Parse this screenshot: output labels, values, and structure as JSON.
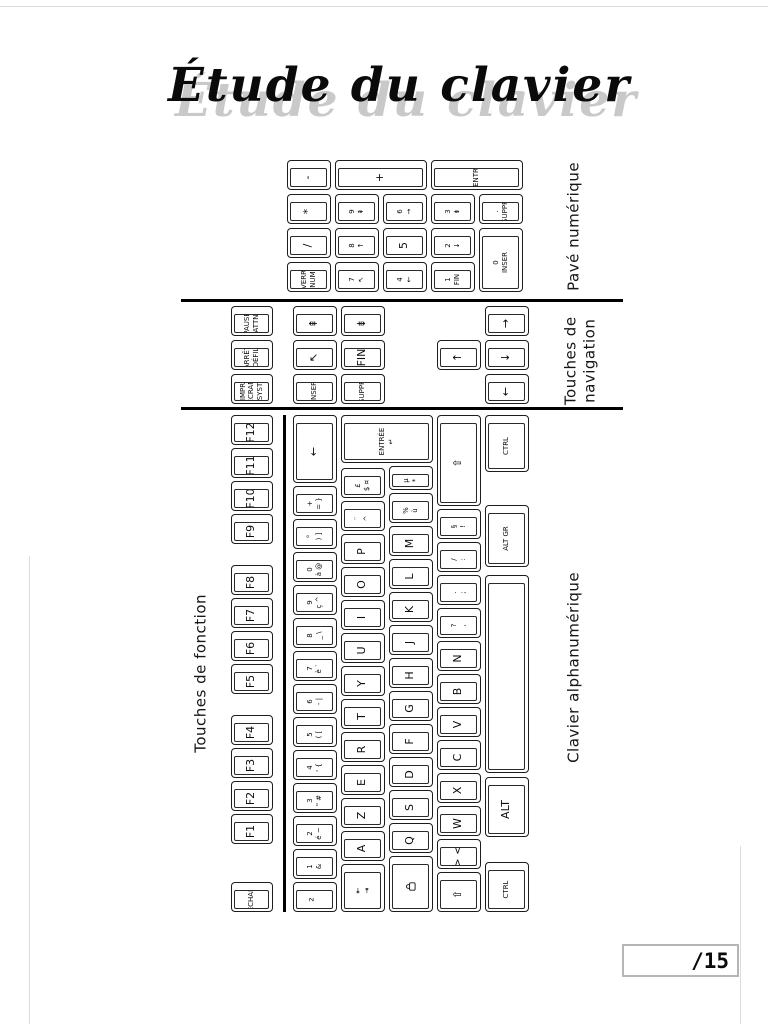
{
  "title": {
    "text": "Étude du clavier"
  },
  "score_box": {
    "value": "/15"
  },
  "section_labels": {
    "pave": "Pavé numérique",
    "nav_line1": "Touches de",
    "nav_line2": "navigation",
    "fonction": "Touches de fonction",
    "alpha": "Clavier alphanumérique"
  },
  "colors": {
    "ink": "#111111",
    "shadow": "#c9c9c9",
    "rule": "#000000",
    "score_border": "#b5b5b5"
  },
  "keyboard": {
    "orientation": "rotated-90-ccw",
    "keys": [
      {
        "n": "key-echap",
        "x": 0,
        "y": 6,
        "w": 30,
        "h": 42,
        "t": [
          "ÉCHAP"
        ]
      },
      {
        "n": "key-f1",
        "x": 68,
        "y": 6,
        "w": 30,
        "h": 42,
        "t": [
          "F1"
        ]
      },
      {
        "n": "key-f2",
        "x": 101,
        "y": 6,
        "w": 30,
        "h": 42,
        "t": [
          "F2"
        ]
      },
      {
        "n": "key-f3",
        "x": 134,
        "y": 6,
        "w": 30,
        "h": 42,
        "t": [
          "F3"
        ]
      },
      {
        "n": "key-f4",
        "x": 167,
        "y": 6,
        "w": 30,
        "h": 42,
        "t": [
          "F4"
        ]
      },
      {
        "n": "key-f5",
        "x": 218,
        "y": 6,
        "w": 30,
        "h": 42,
        "t": [
          "F5"
        ]
      },
      {
        "n": "key-f6",
        "x": 251,
        "y": 6,
        "w": 30,
        "h": 42,
        "t": [
          "F6"
        ]
      },
      {
        "n": "key-f7",
        "x": 284,
        "y": 6,
        "w": 30,
        "h": 42,
        "t": [
          "F7"
        ]
      },
      {
        "n": "key-f8",
        "x": 317,
        "y": 6,
        "w": 30,
        "h": 42,
        "t": [
          "F8"
        ]
      },
      {
        "n": "key-f9",
        "x": 368,
        "y": 6,
        "w": 30,
        "h": 42,
        "t": [
          "F9"
        ]
      },
      {
        "n": "key-f10",
        "x": 401,
        "y": 6,
        "w": 30,
        "h": 42,
        "t": [
          "F10"
        ]
      },
      {
        "n": "key-f11",
        "x": 434,
        "y": 6,
        "w": 30,
        "h": 42,
        "t": [
          "F11"
        ]
      },
      {
        "n": "key-f12",
        "x": 467,
        "y": 6,
        "w": 30,
        "h": 42,
        "t": [
          "F12"
        ]
      },
      {
        "n": "key-superscript2",
        "x": 0,
        "y": 68,
        "w": 30,
        "h": 44,
        "t": [
          "²"
        ]
      },
      {
        "n": "key-1",
        "x": 33,
        "y": 68,
        "w": 30,
        "h": 44,
        "t": [
          "1",
          "&"
        ]
      },
      {
        "n": "key-2",
        "x": 66,
        "y": 68,
        "w": 30,
        "h": 44,
        "t": [
          "2",
          "é ~"
        ]
      },
      {
        "n": "key-3",
        "x": 99,
        "y": 68,
        "w": 30,
        "h": 44,
        "t": [
          "3",
          "\" #"
        ]
      },
      {
        "n": "key-4",
        "x": 132,
        "y": 68,
        "w": 30,
        "h": 44,
        "t": [
          "4",
          "' {"
        ]
      },
      {
        "n": "key-5",
        "x": 165,
        "y": 68,
        "w": 30,
        "h": 44,
        "t": [
          "5",
          "( ["
        ]
      },
      {
        "n": "key-6",
        "x": 198,
        "y": 68,
        "w": 30,
        "h": 44,
        "t": [
          "6",
          "- |"
        ]
      },
      {
        "n": "key-7",
        "x": 231,
        "y": 68,
        "w": 30,
        "h": 44,
        "t": [
          "7",
          "è `"
        ]
      },
      {
        "n": "key-8",
        "x": 264,
        "y": 68,
        "w": 30,
        "h": 44,
        "t": [
          "8",
          "_ \\"
        ]
      },
      {
        "n": "key-9",
        "x": 297,
        "y": 68,
        "w": 30,
        "h": 44,
        "t": [
          "9",
          "ç ^"
        ]
      },
      {
        "n": "key-0",
        "x": 330,
        "y": 68,
        "w": 30,
        "h": 44,
        "t": [
          "0",
          "à @"
        ]
      },
      {
        "n": "key-degree",
        "x": 363,
        "y": 68,
        "w": 30,
        "h": 44,
        "t": [
          "°",
          ") ]"
        ]
      },
      {
        "n": "key-plus-equal",
        "x": 396,
        "y": 68,
        "w": 30,
        "h": 44,
        "t": [
          "+",
          "= }"
        ]
      },
      {
        "n": "key-backspace",
        "x": 429,
        "y": 68,
        "w": 68,
        "h": 44,
        "t": [
          "←"
        ]
      },
      {
        "n": "key-tab",
        "x": 0,
        "y": 116,
        "w": 48,
        "h": 44,
        "t": [
          "⇤",
          "⇥"
        ]
      },
      {
        "n": "key-a",
        "x": 51,
        "y": 116,
        "w": 30,
        "h": 44,
        "t": [
          "A"
        ]
      },
      {
        "n": "key-z",
        "x": 84,
        "y": 116,
        "w": 30,
        "h": 44,
        "t": [
          "Z"
        ]
      },
      {
        "n": "key-e",
        "x": 117,
        "y": 116,
        "w": 30,
        "h": 44,
        "t": [
          "E"
        ]
      },
      {
        "n": "key-r",
        "x": 150,
        "y": 116,
        "w": 30,
        "h": 44,
        "t": [
          "R"
        ]
      },
      {
        "n": "key-t",
        "x": 183,
        "y": 116,
        "w": 30,
        "h": 44,
        "t": [
          "T"
        ]
      },
      {
        "n": "key-y",
        "x": 216,
        "y": 116,
        "w": 30,
        "h": 44,
        "t": [
          "Y"
        ]
      },
      {
        "n": "key-u",
        "x": 249,
        "y": 116,
        "w": 30,
        "h": 44,
        "t": [
          "U"
        ]
      },
      {
        "n": "key-i",
        "x": 282,
        "y": 116,
        "w": 30,
        "h": 44,
        "t": [
          "I"
        ]
      },
      {
        "n": "key-o",
        "x": 315,
        "y": 116,
        "w": 30,
        "h": 44,
        "t": [
          "O"
        ]
      },
      {
        "n": "key-p",
        "x": 348,
        "y": 116,
        "w": 30,
        "h": 44,
        "t": [
          "P"
        ]
      },
      {
        "n": "key-circumflex",
        "x": 381,
        "y": 116,
        "w": 30,
        "h": 44,
        "t": [
          "¨",
          "^"
        ]
      },
      {
        "n": "key-dollar",
        "x": 414,
        "y": 116,
        "w": 30,
        "h": 44,
        "t": [
          "£",
          "$ ¤"
        ]
      },
      {
        "n": "key-entree",
        "x": 449,
        "y": 116,
        "w": 48,
        "h": 92,
        "t": [
          "ENTRÉE",
          "↵"
        ]
      },
      {
        "n": "key-verr-maj",
        "x": 0,
        "y": 164,
        "w": 56,
        "h": 44,
        "t": [],
        "icon": "padlock-icon"
      },
      {
        "n": "key-q",
        "x": 59,
        "y": 164,
        "w": 30,
        "h": 44,
        "t": [
          "Q"
        ]
      },
      {
        "n": "key-s",
        "x": 92,
        "y": 164,
        "w": 30,
        "h": 44,
        "t": [
          "S"
        ]
      },
      {
        "n": "key-d",
        "x": 125,
        "y": 164,
        "w": 30,
        "h": 44,
        "t": [
          "D"
        ]
      },
      {
        "n": "key-f",
        "x": 158,
        "y": 164,
        "w": 30,
        "h": 44,
        "t": [
          "F"
        ]
      },
      {
        "n": "key-g",
        "x": 191,
        "y": 164,
        "w": 30,
        "h": 44,
        "t": [
          "G"
        ]
      },
      {
        "n": "key-h",
        "x": 224,
        "y": 164,
        "w": 30,
        "h": 44,
        "t": [
          "H"
        ]
      },
      {
        "n": "key-j",
        "x": 257,
        "y": 164,
        "w": 30,
        "h": 44,
        "t": [
          "J"
        ]
      },
      {
        "n": "key-k",
        "x": 290,
        "y": 164,
        "w": 30,
        "h": 44,
        "t": [
          "K"
        ]
      },
      {
        "n": "key-l",
        "x": 323,
        "y": 164,
        "w": 30,
        "h": 44,
        "t": [
          "L"
        ]
      },
      {
        "n": "key-m",
        "x": 356,
        "y": 164,
        "w": 30,
        "h": 44,
        "t": [
          "M"
        ]
      },
      {
        "n": "key-percent",
        "x": 389,
        "y": 164,
        "w": 30,
        "h": 44,
        "t": [
          "%",
          "ù"
        ]
      },
      {
        "n": "key-asterisk",
        "x": 422,
        "y": 164,
        "w": 24,
        "h": 44,
        "t": [
          "µ",
          "*"
        ]
      },
      {
        "n": "key-shift-left",
        "x": 0,
        "y": 212,
        "w": 40,
        "h": 44,
        "t": [
          "⇧"
        ]
      },
      {
        "n": "key-less-greater",
        "x": 43,
        "y": 212,
        "w": 30,
        "h": 44,
        "t": [
          "> <"
        ]
      },
      {
        "n": "key-w",
        "x": 76,
        "y": 212,
        "w": 30,
        "h": 44,
        "t": [
          "W"
        ]
      },
      {
        "n": "key-x",
        "x": 109,
        "y": 212,
        "w": 30,
        "h": 44,
        "t": [
          "X"
        ]
      },
      {
        "n": "key-c",
        "x": 142,
        "y": 212,
        "w": 30,
        "h": 44,
        "t": [
          "C"
        ]
      },
      {
        "n": "key-v",
        "x": 175,
        "y": 212,
        "w": 30,
        "h": 44,
        "t": [
          "V"
        ]
      },
      {
        "n": "key-b",
        "x": 208,
        "y": 212,
        "w": 30,
        "h": 44,
        "t": [
          "B"
        ]
      },
      {
        "n": "key-n",
        "x": 241,
        "y": 212,
        "w": 30,
        "h": 44,
        "t": [
          "N"
        ]
      },
      {
        "n": "key-comma",
        "x": 274,
        "y": 212,
        "w": 30,
        "h": 44,
        "t": [
          "?",
          ","
        ]
      },
      {
        "n": "key-semicolon",
        "x": 307,
        "y": 212,
        "w": 30,
        "h": 44,
        "t": [
          ".",
          ";"
        ]
      },
      {
        "n": "key-colon",
        "x": 340,
        "y": 212,
        "w": 30,
        "h": 44,
        "t": [
          "/",
          ":"
        ]
      },
      {
        "n": "key-exclamation",
        "x": 373,
        "y": 212,
        "w": 30,
        "h": 44,
        "t": [
          "§",
          "!"
        ]
      },
      {
        "n": "key-shift-right",
        "x": 406,
        "y": 212,
        "w": 91,
        "h": 44,
        "t": [
          "⇧"
        ]
      },
      {
        "n": "key-ctrl-left",
        "x": 0,
        "y": 260,
        "w": 50,
        "h": 44,
        "t": [
          "CTRL"
        ]
      },
      {
        "n": "key-alt",
        "x": 75,
        "y": 260,
        "w": 60,
        "h": 44,
        "t": [
          "ALT"
        ]
      },
      {
        "n": "key-space",
        "x": 139,
        "y": 260,
        "w": 198,
        "h": 44,
        "t": [
          ""
        ]
      },
      {
        "n": "key-altgr",
        "x": 345,
        "y": 260,
        "w": 62,
        "h": 44,
        "t": [
          "ALT GR"
        ]
      },
      {
        "n": "key-ctrl-right",
        "x": 440,
        "y": 260,
        "w": 57,
        "h": 44,
        "t": [
          "CTRL"
        ]
      },
      {
        "n": "key-impr-ecran",
        "x": 508,
        "y": 6,
        "w": 30,
        "h": 42,
        "t": [
          "IMPR",
          "ÉCRAN",
          "SYST"
        ]
      },
      {
        "n": "key-arret-defil",
        "x": 542,
        "y": 6,
        "w": 30,
        "h": 42,
        "t": [
          "ARRÊT",
          "DÉFIL"
        ]
      },
      {
        "n": "key-pause",
        "x": 576,
        "y": 6,
        "w": 30,
        "h": 42,
        "t": [
          "PAUSE",
          "ATTN"
        ]
      },
      {
        "n": "key-inser",
        "x": 508,
        "y": 68,
        "w": 30,
        "h": 44,
        "t": [
          "INSER"
        ]
      },
      {
        "n": "key-origine",
        "x": 542,
        "y": 68,
        "w": 30,
        "h": 44,
        "t": [
          "↖"
        ]
      },
      {
        "n": "key-page-prec",
        "x": 576,
        "y": 68,
        "w": 30,
        "h": 44,
        "t": [
          "⇞"
        ]
      },
      {
        "n": "key-suppr",
        "x": 508,
        "y": 116,
        "w": 30,
        "h": 44,
        "t": [
          "SUPPR"
        ]
      },
      {
        "n": "key-fin",
        "x": 542,
        "y": 116,
        "w": 30,
        "h": 44,
        "t": [
          "FIN"
        ]
      },
      {
        "n": "key-page-suiv",
        "x": 576,
        "y": 116,
        "w": 30,
        "h": 44,
        "t": [
          "⇟"
        ]
      },
      {
        "n": "key-arrow-up",
        "x": 542,
        "y": 212,
        "w": 30,
        "h": 44,
        "t": [
          "↑"
        ]
      },
      {
        "n": "key-arrow-left",
        "x": 508,
        "y": 260,
        "w": 30,
        "h": 44,
        "t": [
          "←"
        ]
      },
      {
        "n": "key-arrow-down",
        "x": 542,
        "y": 260,
        "w": 30,
        "h": 44,
        "t": [
          "↓"
        ]
      },
      {
        "n": "key-arrow-right",
        "x": 576,
        "y": 260,
        "w": 30,
        "h": 44,
        "t": [
          "→"
        ]
      },
      {
        "n": "key-verr-num",
        "x": 620,
        "y": 62,
        "w": 30,
        "h": 44,
        "t": [
          "VERR",
          "NUM"
        ]
      },
      {
        "n": "key-num-divide",
        "x": 654,
        "y": 62,
        "w": 30,
        "h": 44,
        "t": [
          "/"
        ]
      },
      {
        "n": "key-num-multiply",
        "x": 688,
        "y": 62,
        "w": 30,
        "h": 44,
        "t": [
          "*"
        ]
      },
      {
        "n": "key-num-minus",
        "x": 722,
        "y": 62,
        "w": 30,
        "h": 44,
        "t": [
          "-"
        ]
      },
      {
        "n": "key-num-7",
        "x": 620,
        "y": 110,
        "w": 30,
        "h": 44,
        "t": [
          "7",
          "↖"
        ]
      },
      {
        "n": "key-num-8",
        "x": 654,
        "y": 110,
        "w": 30,
        "h": 44,
        "t": [
          "8",
          "↑"
        ]
      },
      {
        "n": "key-num-9",
        "x": 688,
        "y": 110,
        "w": 30,
        "h": 44,
        "t": [
          "9",
          "⇞"
        ]
      },
      {
        "n": "key-num-plus",
        "x": 722,
        "y": 110,
        "w": 30,
        "h": 92,
        "t": [
          "+"
        ]
      },
      {
        "n": "key-num-4",
        "x": 620,
        "y": 158,
        "w": 30,
        "h": 44,
        "t": [
          "4",
          "←"
        ]
      },
      {
        "n": "key-num-5",
        "x": 654,
        "y": 158,
        "w": 30,
        "h": 44,
        "t": [
          "5"
        ]
      },
      {
        "n": "key-num-6",
        "x": 688,
        "y": 158,
        "w": 30,
        "h": 44,
        "t": [
          "6",
          "→"
        ]
      },
      {
        "n": "key-num-1",
        "x": 620,
        "y": 206,
        "w": 30,
        "h": 44,
        "t": [
          "1",
          "FIN"
        ]
      },
      {
        "n": "key-num-2",
        "x": 654,
        "y": 206,
        "w": 30,
        "h": 44,
        "t": [
          "2",
          "↓"
        ]
      },
      {
        "n": "key-num-3",
        "x": 688,
        "y": 206,
        "w": 30,
        "h": 44,
        "t": [
          "3",
          "⇟"
        ]
      },
      {
        "n": "key-num-entr",
        "x": 722,
        "y": 206,
        "w": 30,
        "h": 92,
        "t": [
          "ENTR"
        ]
      },
      {
        "n": "key-num-0",
        "x": 620,
        "y": 254,
        "w": 64,
        "h": 44,
        "t": [
          "0",
          "INSER"
        ]
      },
      {
        "n": "key-num-suppr",
        "x": 688,
        "y": 254,
        "w": 30,
        "h": 44,
        "t": [
          ".",
          "SUPPR"
        ]
      }
    ]
  }
}
